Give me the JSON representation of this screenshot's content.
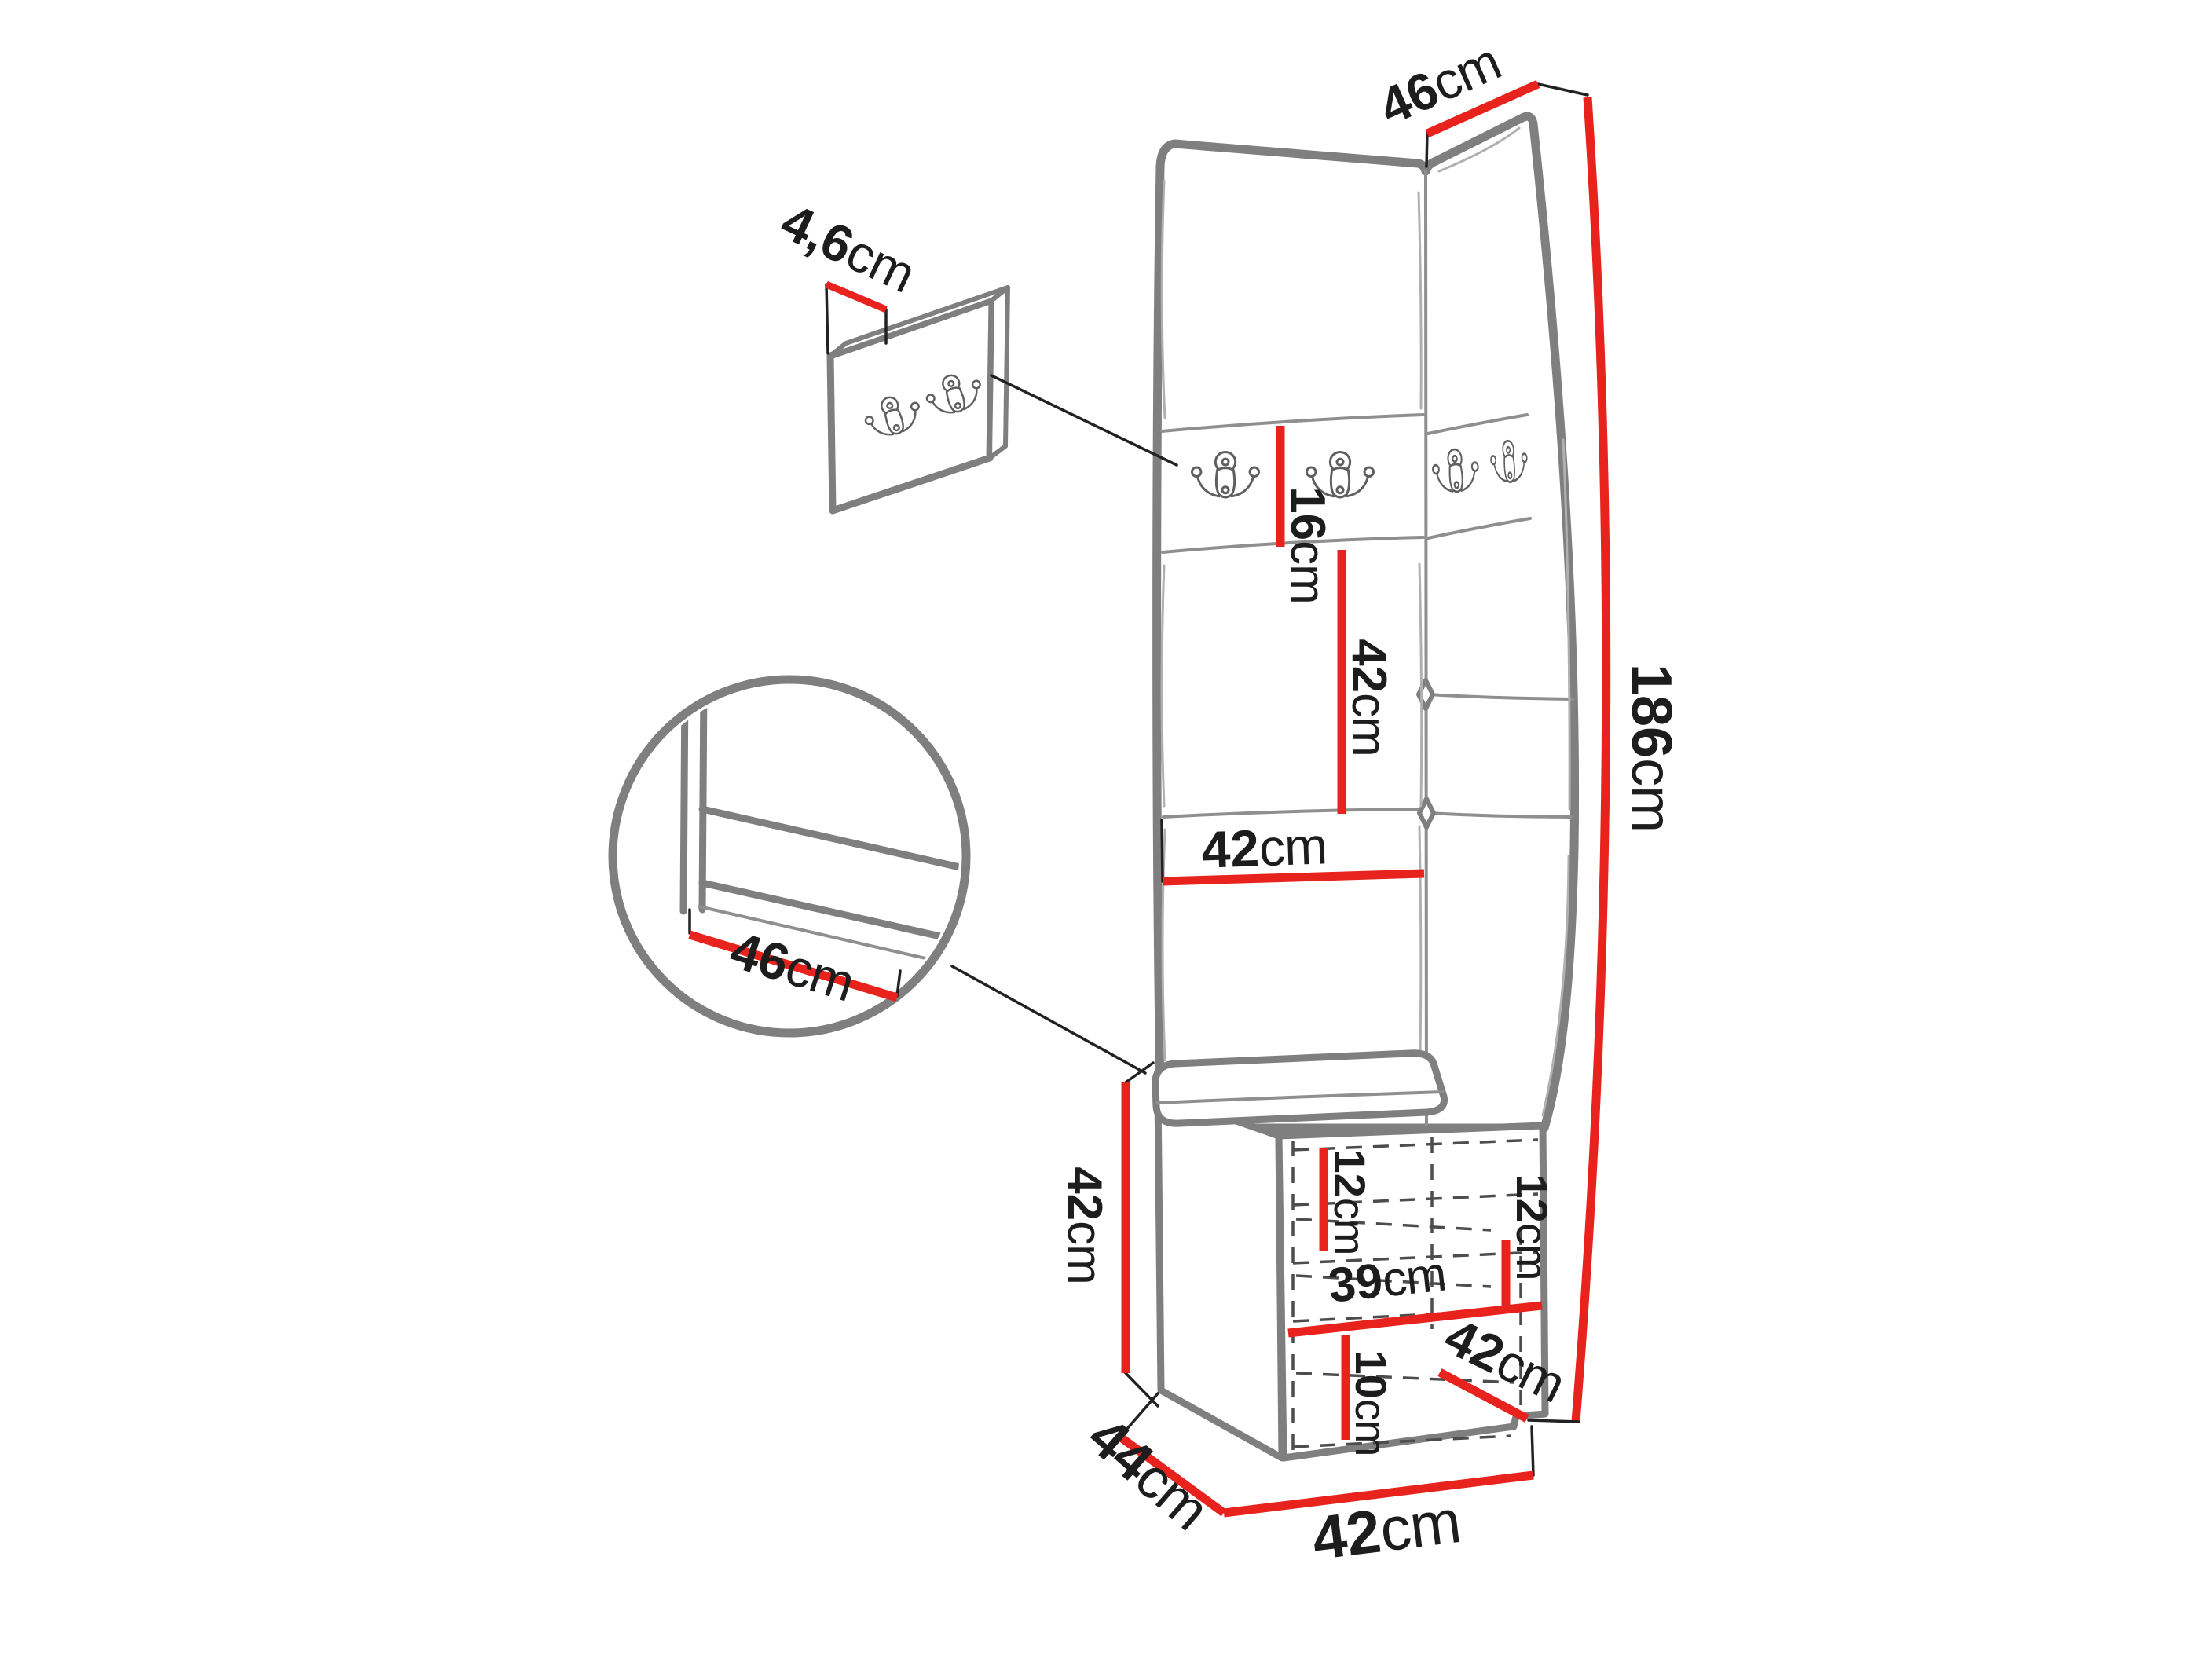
{
  "colors": {
    "dimension_line": "#e8231d",
    "outline_gray": "#7f7f7f",
    "text_black": "#1d1d1d",
    "background": "#ffffff"
  },
  "dimensions": {
    "wall_panel_thickness": {
      "num": "4,6",
      "unit": "cm"
    },
    "top_panel_width": {
      "num": "46",
      "unit": "cm"
    },
    "hook_strip_height": {
      "num": "16",
      "unit": "cm"
    },
    "mid_panel_height": {
      "num": "42",
      "unit": "cm"
    },
    "panel_width": {
      "num": "42",
      "unit": "cm"
    },
    "total_height": {
      "num": "186",
      "unit": "cm"
    },
    "cabinet_height": {
      "num": "42",
      "unit": "cm"
    },
    "upper_shelf_spacing": {
      "num": "12",
      "unit": "cm"
    },
    "right_shelf_spacing": {
      "num": "12",
      "unit": "cm"
    },
    "cabinet_inner_width": {
      "num": "39",
      "unit": "cm"
    },
    "bottom_shelf_spacing": {
      "num": "10",
      "unit": "cm"
    },
    "door_diagonal": {
      "num": "42",
      "unit": "cm"
    },
    "cabinet_width": {
      "num": "42",
      "unit": "cm"
    },
    "cabinet_depth": {
      "num": "44",
      "unit": "cm"
    },
    "seat_depth": {
      "num": "46",
      "unit": "cm"
    }
  }
}
